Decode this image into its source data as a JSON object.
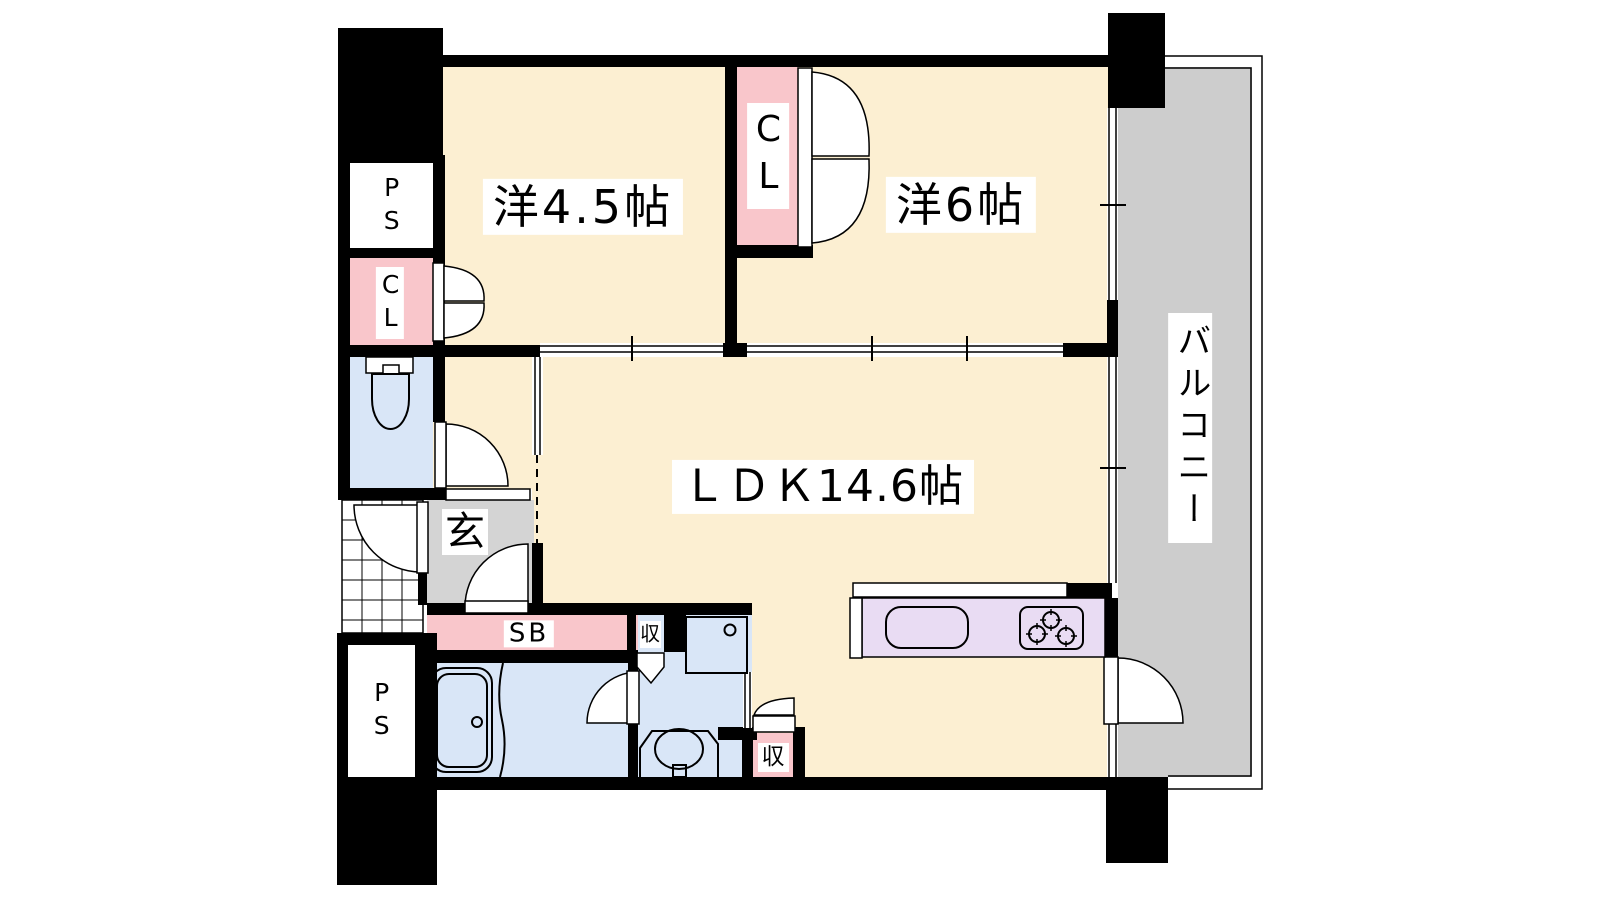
{
  "plan_type": "floor-plan",
  "colors": {
    "wall": "#000000",
    "cream": "#fcefd2",
    "pink": "#f9c6cb",
    "blue": "#d9e6f7",
    "gray-genkan": "#d4d4d4",
    "gray-balcony": "#cdcdcd",
    "purple": "#e9dcf3",
    "paper": "#ffffff",
    "ink": "#000000"
  },
  "labels": {
    "bedroom_45": "洋4.5帖",
    "bedroom_6": "洋6帖",
    "ldk": "ＬＤＫ14.6帖",
    "balcony": "バルコニー",
    "closet_top": "CL",
    "closet_left": "CL",
    "pipe_space_top": "PS",
    "pipe_space_bottom": "PS",
    "entrance": "玄",
    "shoe_box": "SB",
    "storage_washroom": "収",
    "storage_ldk": "収"
  },
  "rooms": [
    {
      "id": "bedroom_45",
      "label": "洋4.5帖",
      "kind": "western-room"
    },
    {
      "id": "bedroom_6",
      "label": "洋6帖",
      "kind": "western-room"
    },
    {
      "id": "ldk",
      "label": "ＬＤＫ14.6帖",
      "kind": "living-dining-kitchen"
    },
    {
      "id": "balcony",
      "label": "バルコニー",
      "kind": "balcony"
    },
    {
      "id": "entrance",
      "label": "玄",
      "kind": "genkan"
    },
    {
      "id": "closet_top",
      "label": "CL",
      "kind": "closet"
    },
    {
      "id": "closet_left",
      "label": "CL",
      "kind": "closet"
    },
    {
      "id": "pipe_space_top",
      "label": "PS",
      "kind": "pipe-space"
    },
    {
      "id": "pipe_space_bottom",
      "label": "PS",
      "kind": "pipe-space"
    },
    {
      "id": "shoe_box",
      "label": "SB",
      "kind": "shoe-box"
    },
    {
      "id": "storage_washroom",
      "label": "収",
      "kind": "storage"
    },
    {
      "id": "storage_ldk",
      "label": "収",
      "kind": "storage"
    }
  ]
}
